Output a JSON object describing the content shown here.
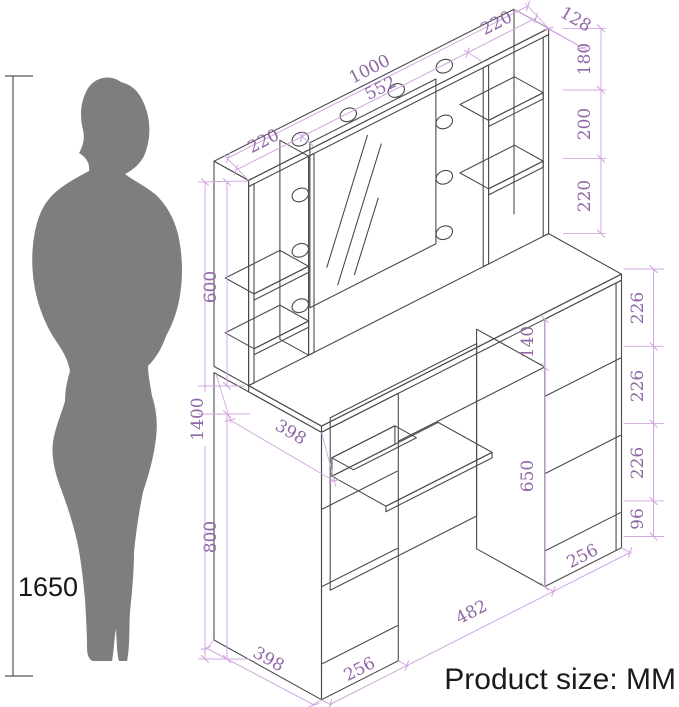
{
  "title": "Vanity dressing table dimension diagram",
  "units_note": "Product size: MM",
  "person": {
    "height_label": "1650"
  },
  "footer": {
    "product_size_label": "Product size: MM"
  },
  "colors": {
    "outline": "#4b4b4b",
    "dimension_line": "#d2a7e0",
    "dimension_text": "#8f68a5",
    "silhouette": "#7e7e7e",
    "person_line": "#555555",
    "background": "#ffffff"
  },
  "dims": {
    "top_width": "1000",
    "mirror_width": "552",
    "top_left": "220",
    "top_right": "220",
    "hutch_depth": "128",
    "right_seg1": "180",
    "right_seg2": "200",
    "right_seg3": "220",
    "hutch_height": "600",
    "total_height": "1400",
    "desk_height": "800",
    "depth_upper": "398",
    "depth_lower": "398",
    "apron_height": "140",
    "knee_height": "650",
    "drawer1": "226",
    "drawer2": "226",
    "drawer3": "226",
    "kick_height": "96",
    "width_left": "256",
    "width_center": "482",
    "width_right": "256"
  }
}
